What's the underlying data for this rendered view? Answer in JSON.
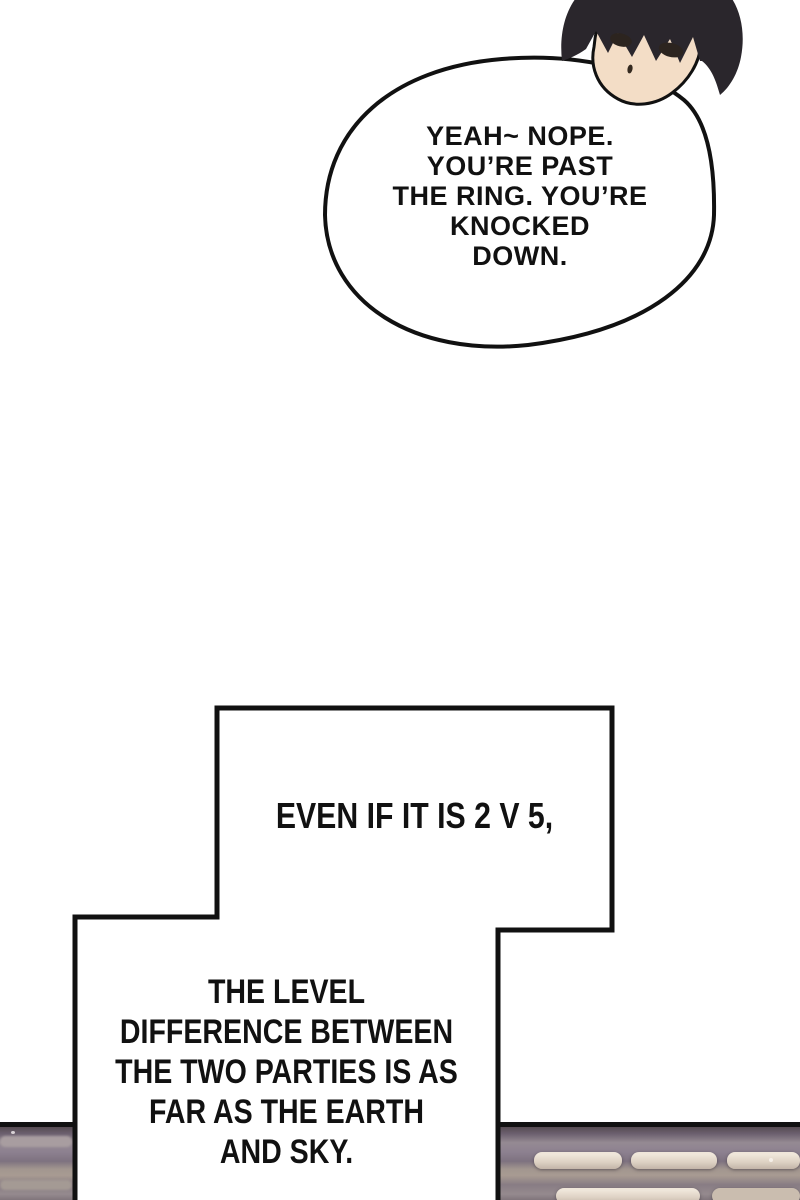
{
  "page": {
    "type": "comic page",
    "background": "#ffffff"
  },
  "colors": {
    "paper": "#ffffff",
    "ink": "#111111",
    "skin": "#f3ddc6",
    "hair": "#2a262c",
    "eye": "#2c241f",
    "panelMauve": "#8d8190",
    "panelDark": "#564b52",
    "panelLight": "#e8ddd0"
  },
  "speech_bubble": {
    "text": "YEAH~ NOPE. YOU’RE PAST THE RING. YOU’RE KNOCKED DOWN.",
    "lines": [
      "YEAH~ NOPE.",
      "YOU’RE PAST",
      "THE RING. YOU’RE",
      "KNOCKED",
      "DOWN."
    ]
  },
  "narration_box_1": {
    "text": "EVEN IF IT IS 2 V 5,",
    "lines": [
      "EVEN IF IT IS 2 V 5,"
    ]
  },
  "narration_box_2": {
    "text": "THE LEVEL DIFFERENCE BETWEEN THE TWO PARTIES IS AS FAR AS THE EARTH AND SKY.",
    "lines": [
      "THE LEVEL",
      "DIFFERENCE BETWEEN",
      "THE TWO PARTIES IS AS",
      "FAR AS THE EARTH",
      "AND SKY."
    ]
  },
  "character": {
    "description": "black-haired boy head, deadpan expression, top right, partially cut off by page edge"
  },
  "bottom_panel": {
    "description": "edge of ring stage / padded steps, mauve-gray with light beige bars"
  }
}
